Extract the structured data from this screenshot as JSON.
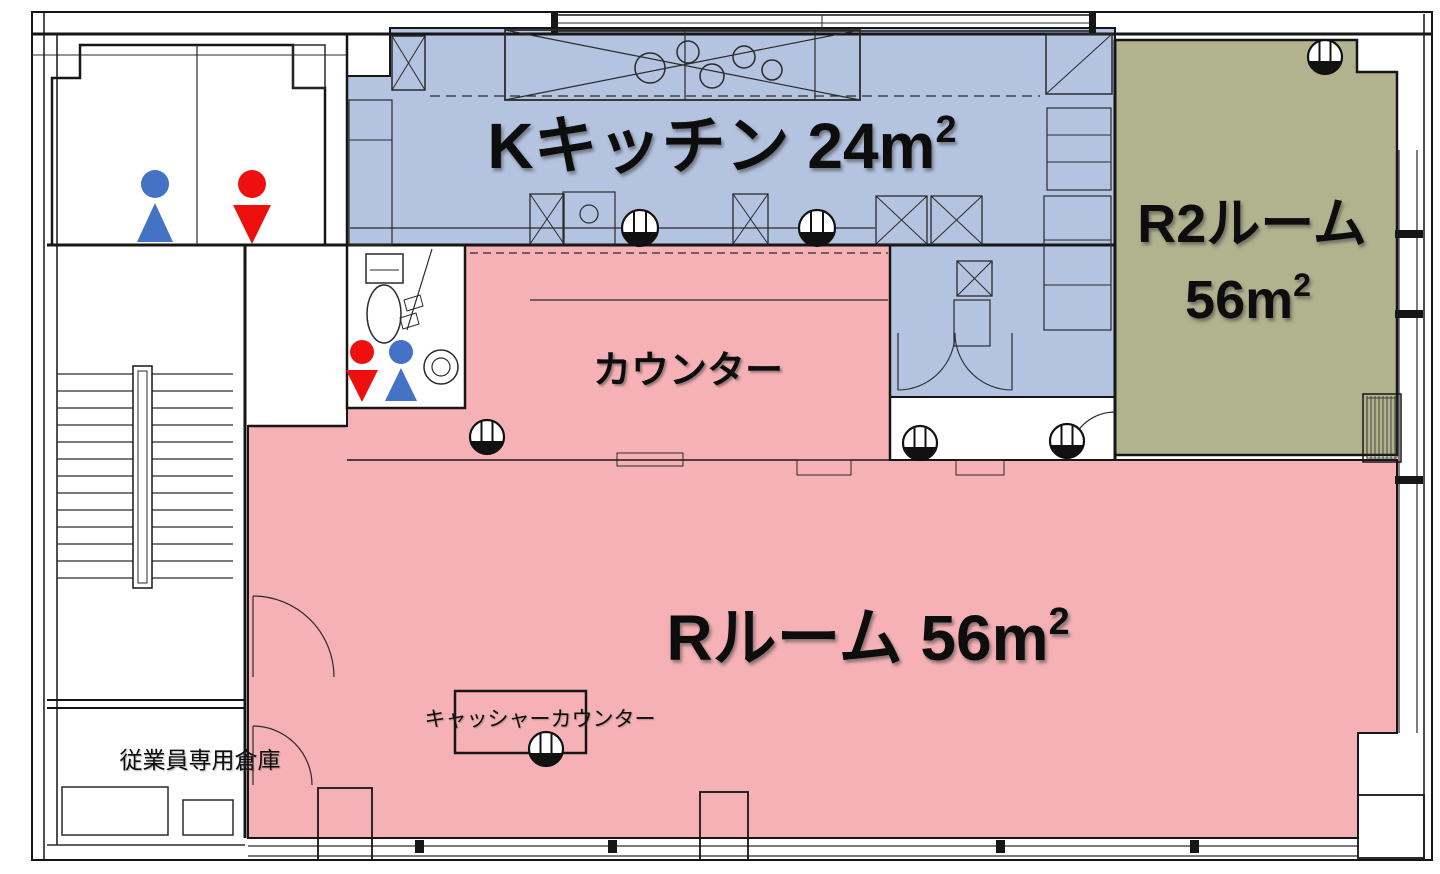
{
  "plan": {
    "type": "floor-plan",
    "rooms": [
      {
        "id": "kitchen",
        "label": "Kキッチン 24m²",
        "fill_key": "kitchen"
      },
      {
        "id": "room2",
        "label": "R2ルーム 56m²",
        "fill_key": "room2"
      },
      {
        "id": "counter",
        "label": "カウンター",
        "fill_key": "pink"
      },
      {
        "id": "room_r",
        "label": "Rルーム 56m²",
        "fill_key": "pink"
      },
      {
        "id": "storage",
        "label": "従業員専用倉庫",
        "fill_key": "white"
      },
      {
        "id": "cashier",
        "label": "キャッシャーカウンター",
        "fill_key": "pink"
      }
    ]
  },
  "labels": {
    "kitchen": {
      "main": "Kキッチン 24m",
      "sup": "2"
    },
    "room2": {
      "line1": "R2ルーム",
      "area_main": "56m",
      "area_sup": "2"
    },
    "counter": {
      "label": "カウンター"
    },
    "room_r": {
      "main": "Rルーム 56m",
      "sup": "2"
    },
    "cashier": {
      "label": "キャッシャーカウンター"
    },
    "storage": {
      "label": "従業員専用倉庫"
    }
  },
  "colors": {
    "kitchen": "#b4c3e0",
    "room2": "#b1b38f",
    "pink": "#f5b1b5",
    "male": "#4472c4",
    "female": "#ee0f0f",
    "ink": "#161616",
    "white": "#ffffff"
  }
}
